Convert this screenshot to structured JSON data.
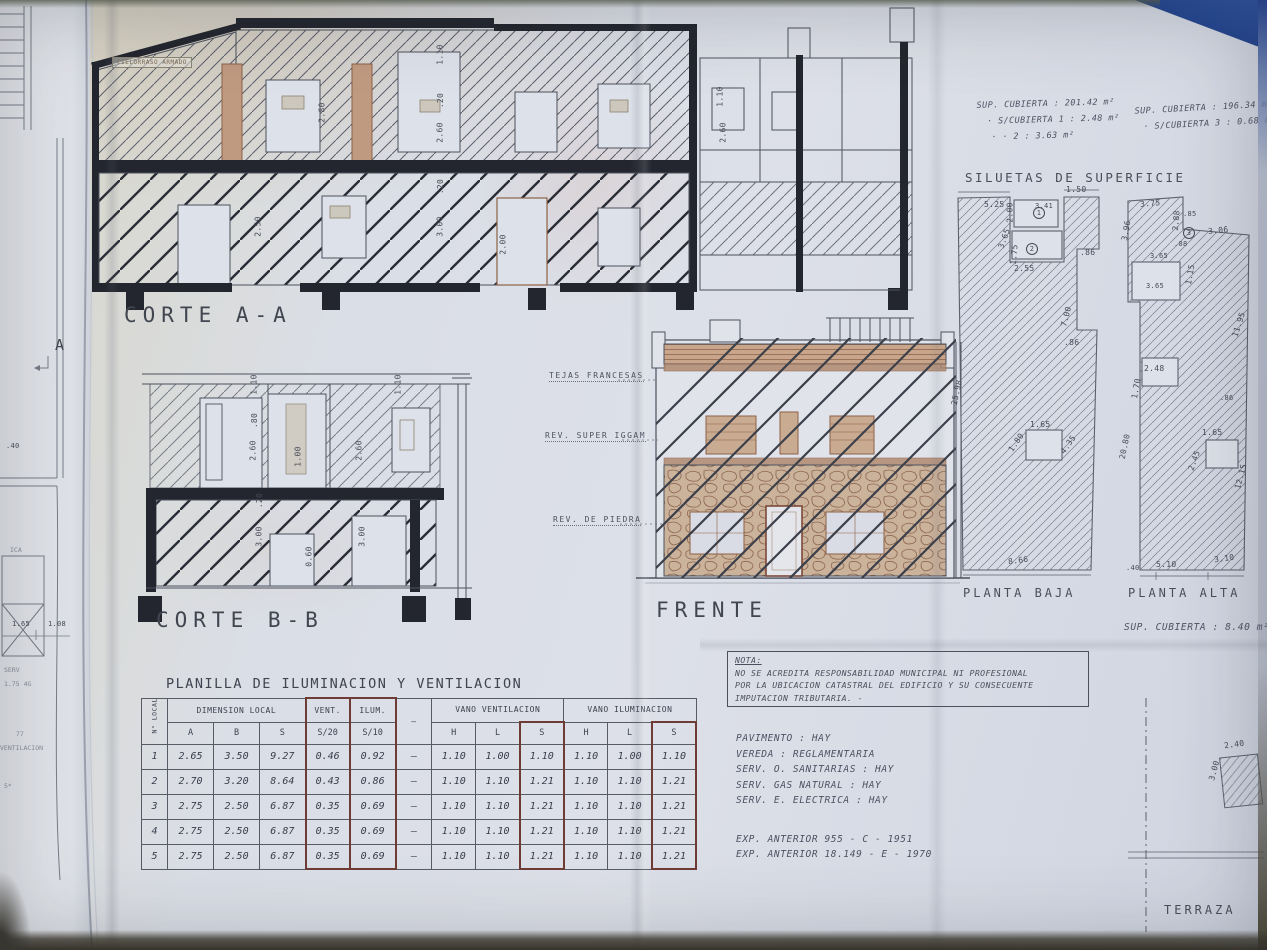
{
  "titles": {
    "corte_aa": "CORTE A-A",
    "corte_bb": "CORTE B-B",
    "frente": "FRENTE",
    "siluetas": "SILUETAS DE SUPERFICIE",
    "planta_baja": "PLANTA BAJA",
    "planta_alta": "PLANTA ALTA",
    "terraza": "TERRAZA",
    "planilla": "PLANILLA DE ILUMINACION Y VENTILACION"
  },
  "marker_a": "A",
  "corte_note": "CIELORRASO ARMADO",
  "superficies": {
    "left_col": [
      "SUP. CUBIERTA : 201.42 m²",
      "· S/CUBIERTA 1 :  2.48 m²",
      "·     ·      2 :  3.63 m²"
    ],
    "right_col": [
      "SUP. CUBIERTA : 196.34 m²",
      "· S/CUBIERTA 3 : 0.68 m²"
    ],
    "planta_alta_sup": "SUP. CUBIERTA :  8.40 m²"
  },
  "frente_callouts": {
    "tejas": "TEJAS FRANCESAS",
    "rev_super": "REV. SUPER IGGAM",
    "rev_piedra": "REV. DE PIEDRA"
  },
  "nota": {
    "title": "NOTA:",
    "lines": [
      "NO SE ACREDITA RESPONSABILIDAD MUNICIPAL NI PROFESIONAL",
      "POR LA UBICACION CATASTRAL DEL EDIFICIO Y SU CONSECUENTE",
      "IMPUTACION TRIBUTARIA. -"
    ]
  },
  "servicios": [
    "PAVIMENTO :  HAY",
    "VEREDA : REGLAMENTARIA",
    "SERV. O. SANITARIAS :  HAY",
    "SERV. GAS NATURAL :  HAY",
    "SERV. E. ELECTRICA :  HAY"
  ],
  "expedientes": [
    "EXP. ANTERIOR   955 - C - 1951",
    "EXP. ANTERIOR  18.149 - E - 1970"
  ],
  "planilla": {
    "col_local": "N° LOCAL",
    "groups": [
      "DIMENSION LOCAL",
      "VENT.",
      "ILUM.",
      "VANO VENTILACION",
      "VANO ILUMINACION"
    ],
    "subheaders": [
      "A",
      "B",
      "S",
      "S/20",
      "S/10",
      "H",
      "L",
      "S",
      "H",
      "L",
      "S"
    ],
    "dash": "—",
    "rows": [
      [
        "1",
        "2.65",
        "3.50",
        "9.27",
        "0.46",
        "0.92",
        "—",
        "1.10",
        "1.00",
        "1.10",
        "1.10",
        "1.00",
        "1.10"
      ],
      [
        "2",
        "2.70",
        "3.20",
        "8.64",
        "0.43",
        "0.86",
        "—",
        "1.10",
        "1.10",
        "1.21",
        "1.10",
        "1.10",
        "1.21"
      ],
      [
        "3",
        "2.75",
        "2.50",
        "6.87",
        "0.35",
        "0.69",
        "—",
        "1.10",
        "1.10",
        "1.21",
        "1.10",
        "1.10",
        "1.21"
      ],
      [
        "4",
        "2.75",
        "2.50",
        "6.87",
        "0.35",
        "0.69",
        "—",
        "1.10",
        "1.10",
        "1.21",
        "1.10",
        "1.10",
        "1.21"
      ],
      [
        "5",
        "2.75",
        "2.50",
        "6.87",
        "0.35",
        "0.69",
        "—",
        "1.10",
        "1.10",
        "1.21",
        "1.10",
        "1.10",
        "1.21"
      ]
    ]
  },
  "annotations": [
    {
      "t": "1.10",
      "x": 430,
      "y": 50,
      "r": -90
    },
    {
      "t": ".20",
      "x": 433,
      "y": 96,
      "r": -90
    },
    {
      "t": "2.60",
      "x": 430,
      "y": 128,
      "r": -90
    },
    {
      "t": ".20",
      "x": 433,
      "y": 182,
      "r": -90
    },
    {
      "t": "3.00",
      "x": 430,
      "y": 222,
      "r": -90
    },
    {
      "t": "2.00",
      "x": 493,
      "y": 240,
      "r": -90
    },
    {
      "t": "2.80",
      "x": 312,
      "y": 108,
      "r": -90
    },
    {
      "t": "2.50",
      "x": 248,
      "y": 222,
      "r": -90
    },
    {
      "t": "1.10",
      "x": 710,
      "y": 92,
      "r": -90
    },
    {
      "t": "2.60",
      "x": 713,
      "y": 128,
      "r": -90
    },
    {
      "t": "1.10",
      "x": 244,
      "y": 380,
      "r": -90
    },
    {
      "t": "1.10",
      "x": 388,
      "y": 380,
      "r": -90
    },
    {
      "t": ".80",
      "x": 247,
      "y": 416,
      "r": -90
    },
    {
      "t": "2.60",
      "x": 243,
      "y": 446,
      "r": -90
    },
    {
      "t": "1.00",
      "x": 288,
      "y": 452,
      "r": -90
    },
    {
      "t": "2.60",
      "x": 349,
      "y": 446,
      "r": -90
    },
    {
      "t": ".20",
      "x": 252,
      "y": 496,
      "r": -90
    },
    {
      "t": "3.00",
      "x": 249,
      "y": 532,
      "r": -90
    },
    {
      "t": "0.60",
      "x": 299,
      "y": 552,
      "r": -90
    },
    {
      "t": "3.00",
      "x": 352,
      "y": 532,
      "r": -90
    },
    {
      "t": ".40",
      "x": 6,
      "y": 442,
      "c": "sm"
    },
    {
      "t": "ICA",
      "x": 10,
      "y": 546,
      "c": "faint"
    },
    {
      "t": "1.65",
      "x": 12,
      "y": 620,
      "c": "sm"
    },
    {
      "t": "1.08",
      "x": 48,
      "y": 620,
      "c": "sm"
    },
    {
      "t": "SERV",
      "x": 4,
      "y": 666,
      "c": "faint"
    },
    {
      "t": "1.75 4G",
      "x": 4,
      "y": 680,
      "c": "faint"
    },
    {
      "t": "77",
      "x": 16,
      "y": 730,
      "c": "faint"
    },
    {
      "t": "VENTILACION",
      "x": 0,
      "y": 744,
      "c": "faint"
    },
    {
      "t": "5*",
      "x": 4,
      "y": 782,
      "c": "faint"
    },
    {
      "t": "5.25",
      "x": 984,
      "y": 200
    },
    {
      "t": "1.50",
      "x": 1066,
      "y": 185
    },
    {
      "t": "2.00",
      "x": 1000,
      "y": 208,
      "r": -90
    },
    {
      "t": "3.41",
      "x": 1035,
      "y": 202,
      "c": "sm"
    },
    {
      "t": "2.55",
      "x": 1014,
      "y": 264
    },
    {
      "t": ".86",
      "x": 1080,
      "y": 248
    },
    {
      "t": "3.65",
      "x": 994,
      "y": 234,
      "r": -70
    },
    {
      "t": "1.75",
      "x": 1004,
      "y": 250,
      "r": -85
    },
    {
      "t": "7.00",
      "x": 1056,
      "y": 312,
      "r": -75
    },
    {
      "t": ".86",
      "x": 1064,
      "y": 338
    },
    {
      "t": "25.98",
      "x": 944,
      "y": 388,
      "r": -78
    },
    {
      "t": "1.65",
      "x": 1030,
      "y": 420
    },
    {
      "t": "1.80",
      "x": 1006,
      "y": 438,
      "r": -55
    },
    {
      "t": "4.35",
      "x": 1058,
      "y": 440,
      "r": -55
    },
    {
      "t": "8.66",
      "x": 1008,
      "y": 556,
      "r": -8
    },
    {
      "t": "1",
      "x": 1033,
      "y": 207,
      "c": "circ"
    },
    {
      "t": "2",
      "x": 1026,
      "y": 243,
      "c": "circ"
    },
    {
      "t": "3.75",
      "x": 1140,
      "y": 199,
      "r": -5
    },
    {
      "t": "3.96",
      "x": 1116,
      "y": 226,
      "r": -80
    },
    {
      "t": "2.88",
      "x": 1166,
      "y": 216,
      "r": -85
    },
    {
      "t": ".85",
      "x": 1183,
      "y": 210,
      "c": "sm"
    },
    {
      "t": "3.06",
      "x": 1208,
      "y": 226,
      "r": -6
    },
    {
      "t": ".88",
      "x": 1174,
      "y": 240,
      "c": "sm"
    },
    {
      "t": "3.65",
      "x": 1150,
      "y": 252,
      "c": "sm"
    },
    {
      "t": "1.15",
      "x": 1180,
      "y": 270,
      "r": -80
    },
    {
      "t": "3.65",
      "x": 1146,
      "y": 282,
      "c": "sm"
    },
    {
      "t": "11.95",
      "x": 1226,
      "y": 320,
      "r": -72
    },
    {
      "t": "2.48",
      "x": 1144,
      "y": 364
    },
    {
      "t": "1.70",
      "x": 1126,
      "y": 384,
      "r": -80
    },
    {
      "t": ".86",
      "x": 1220,
      "y": 394,
      "c": "sm"
    },
    {
      "t": "20.80",
      "x": 1112,
      "y": 442,
      "r": -78
    },
    {
      "t": "1.65",
      "x": 1202,
      "y": 428
    },
    {
      "t": "2.45",
      "x": 1184,
      "y": 456,
      "r": -70
    },
    {
      "t": "12.15",
      "x": 1228,
      "y": 472,
      "r": -75
    },
    {
      "t": ".40",
      "x": 1126,
      "y": 564,
      "c": "sm"
    },
    {
      "t": "5.10",
      "x": 1156,
      "y": 560
    },
    {
      "t": "3.10",
      "x": 1214,
      "y": 554,
      "r": -8
    },
    {
      "t": "3",
      "x": 1183,
      "y": 227,
      "c": "circ"
    },
    {
      "t": "2.40",
      "x": 1224,
      "y": 740,
      "r": -8
    },
    {
      "t": "3.00",
      "x": 1204,
      "y": 766,
      "r": -75
    }
  ]
}
